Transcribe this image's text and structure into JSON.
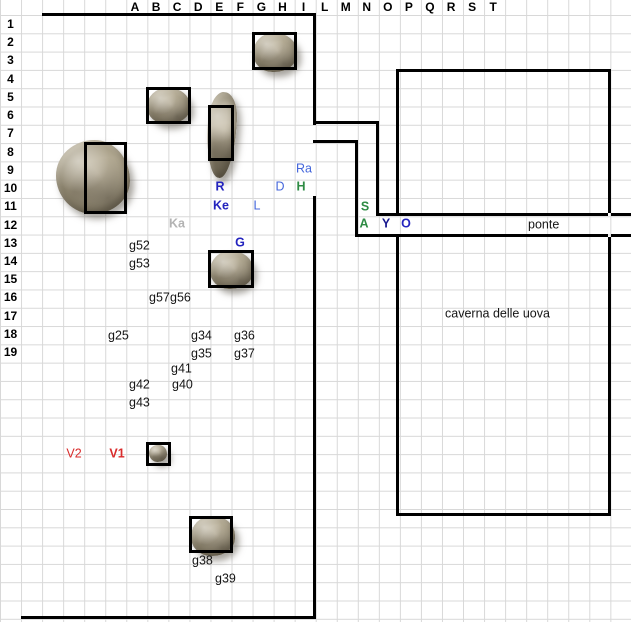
{
  "map": {
    "title": "battle-map-grid",
    "grid": {
      "cell_width": 21.05,
      "cell_height": 18.3,
      "header_height": 15,
      "gridline_color": "#d8d8d8",
      "background_color": "#ffffff"
    },
    "column_headers": [
      "A",
      "B",
      "C",
      "D",
      "E",
      "F",
      "G",
      "H",
      "I",
      "L",
      "M",
      "N",
      "O",
      "P",
      "Q",
      "R",
      "S",
      "T"
    ],
    "column_header_layout": {
      "first_center_x": 135,
      "step": 21.07
    },
    "row_headers": [
      "1",
      "2",
      "3",
      "4",
      "5",
      "6",
      "7",
      "8",
      "9",
      "10",
      "11",
      "12",
      "13",
      "14",
      "15",
      "16",
      "17",
      "18",
      "19"
    ],
    "row_header_layout": {
      "first_center_y": 24,
      "step": 18.23
    },
    "colors": {
      "blue": "#2323BE",
      "blue_light": "#4466DB",
      "navy": "#19198F",
      "green": "#2E8B44",
      "red": "#D92B2B",
      "gray": "#B3B3B3",
      "wall": "#000000"
    },
    "walls": [
      {
        "x": 42,
        "y": 13,
        "w": 274,
        "h": 3
      },
      {
        "x": 313,
        "y": 13,
        "w": 3,
        "h": 112
      },
      {
        "x": 313,
        "y": 121,
        "w": 66,
        "h": 3
      },
      {
        "x": 376,
        "y": 121,
        "w": 3,
        "h": 95
      },
      {
        "x": 376,
        "y": 213,
        "w": 232,
        "h": 3
      },
      {
        "x": 611,
        "y": 213,
        "w": 20,
        "h": 3
      },
      {
        "x": 313,
        "y": 140,
        "w": 45,
        "h": 3
      },
      {
        "x": 355,
        "y": 140,
        "w": 3,
        "h": 97
      },
      {
        "x": 355,
        "y": 234,
        "w": 253,
        "h": 3
      },
      {
        "x": 611,
        "y": 234,
        "w": 20,
        "h": 3
      },
      {
        "x": 313,
        "y": 196,
        "w": 3,
        "h": 423
      },
      {
        "x": 21,
        "y": 616,
        "w": 295,
        "h": 3
      },
      {
        "x": 396,
        "y": 69,
        "w": 215,
        "h": 3
      },
      {
        "x": 396,
        "y": 69,
        "w": 3,
        "h": 147
      },
      {
        "x": 396,
        "y": 237,
        "w": 3,
        "h": 279
      },
      {
        "x": 608,
        "y": 69,
        "w": 3,
        "h": 144
      },
      {
        "x": 608,
        "y": 237,
        "w": 3,
        "h": 279
      },
      {
        "x": 396,
        "y": 513,
        "w": 215,
        "h": 3
      }
    ],
    "token_boxes": [
      {
        "x": 252,
        "y": 32,
        "w": 45,
        "h": 38,
        "cells": "G2:H3"
      },
      {
        "x": 146,
        "y": 87,
        "w": 45,
        "h": 37,
        "cells": "B5:C6"
      },
      {
        "x": 208,
        "y": 105,
        "w": 26,
        "h": 56,
        "cells": "E6:E8"
      },
      {
        "x": 84,
        "y": 142,
        "w": 43,
        "h": 72,
        "cells": "A8:B11"
      },
      {
        "x": 208,
        "y": 250,
        "w": 46,
        "h": 38,
        "cells": "E14:F15"
      },
      {
        "x": 146,
        "y": 442,
        "w": 25,
        "h": 24,
        "cells": "B24"
      },
      {
        "x": 189,
        "y": 516,
        "w": 44,
        "h": 37,
        "cells": "D28:E29"
      }
    ],
    "rocks": [
      {
        "x": 253,
        "y": 33,
        "w": 44,
        "h": 39,
        "shape": "round"
      },
      {
        "x": 147,
        "y": 88,
        "w": 43,
        "h": 36,
        "shape": "round"
      },
      {
        "x": 207,
        "y": 92,
        "w": 29,
        "h": 86,
        "shape": "tall"
      },
      {
        "x": 56,
        "y": 140,
        "w": 74,
        "h": 74,
        "shape": "big"
      },
      {
        "x": 210,
        "y": 251,
        "w": 43,
        "h": 38,
        "shape": "round"
      },
      {
        "x": 149,
        "y": 445,
        "w": 18,
        "h": 17,
        "shape": "small"
      },
      {
        "x": 191,
        "y": 516,
        "w": 44,
        "h": 40,
        "shape": "round"
      }
    ],
    "units": [
      {
        "label": "Ra",
        "cell": "I9",
        "color": "blue_light",
        "bold": false,
        "x": 304,
        "y": 169
      },
      {
        "label": "R",
        "cell": "E10",
        "color": "blue",
        "bold": true,
        "x": 220,
        "y": 187
      },
      {
        "label": "D",
        "cell": "H10",
        "color": "blue_light",
        "bold": false,
        "x": 280,
        "y": 187
      },
      {
        "label": "H",
        "cell": "I10",
        "color": "green",
        "bold": true,
        "x": 301,
        "y": 187
      },
      {
        "label": "Ke",
        "cell": "E11",
        "color": "blue",
        "bold": true,
        "x": 221,
        "y": 206
      },
      {
        "label": "L",
        "cell": "G11",
        "color": "blue_light",
        "bold": false,
        "x": 257,
        "y": 206
      },
      {
        "label": "S",
        "cell": "N11",
        "color": "green",
        "bold": true,
        "x": 365,
        "y": 207
      },
      {
        "label": "Ka",
        "cell": "C12",
        "color": "gray",
        "bold": true,
        "x": 177,
        "y": 224
      },
      {
        "label": "A",
        "cell": "N12",
        "color": "green",
        "bold": true,
        "x": 364,
        "y": 224
      },
      {
        "label": "Y",
        "cell": "O12",
        "color": "navy",
        "bold": true,
        "x": 386,
        "y": 224
      },
      {
        "label": "O",
        "cell": "P12",
        "color": "blue",
        "bold": true,
        "x": 406,
        "y": 224
      },
      {
        "label": "G",
        "cell": "F13",
        "color": "blue",
        "bold": true,
        "x": 240,
        "y": 243
      },
      {
        "label": "V2",
        "cell": "row24",
        "color": "red",
        "bold": false,
        "x": 74,
        "y": 454
      },
      {
        "label": "V1",
        "cell": "row24",
        "color": "red",
        "bold": true,
        "x": 117,
        "y": 454
      }
    ],
    "grid_labels": [
      {
        "text": "g52",
        "x": 129,
        "y": 246
      },
      {
        "text": "g53",
        "x": 129,
        "y": 264
      },
      {
        "text": "g57",
        "x": 149,
        "y": 298,
        "clip": 22
      },
      {
        "text": "g56",
        "x": 170,
        "y": 298
      },
      {
        "text": "g25",
        "x": 108,
        "y": 336
      },
      {
        "text": "g34",
        "x": 191,
        "y": 336
      },
      {
        "text": "g36",
        "x": 234,
        "y": 336
      },
      {
        "text": "g35",
        "x": 191,
        "y": 354
      },
      {
        "text": "g37",
        "x": 234,
        "y": 354
      },
      {
        "text": "g41",
        "x": 171,
        "y": 369
      },
      {
        "text": "g42",
        "x": 129,
        "y": 385
      },
      {
        "text": "g40",
        "x": 172,
        "y": 385
      },
      {
        "text": "g43",
        "x": 129,
        "y": 403
      },
      {
        "text": "g38",
        "x": 192,
        "y": 561
      },
      {
        "text": "g39",
        "x": 215,
        "y": 579
      }
    ],
    "place_labels": [
      {
        "text": "ponte",
        "x": 528,
        "y": 225
      },
      {
        "text": "caverna delle uova",
        "x": 445,
        "y": 314
      }
    ]
  }
}
